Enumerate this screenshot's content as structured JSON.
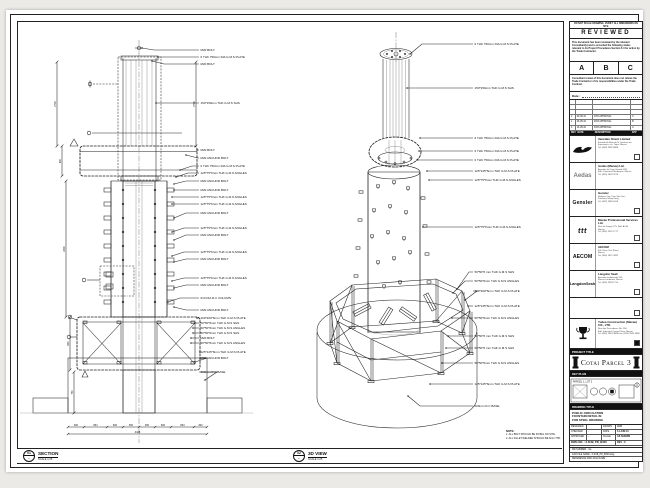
{
  "sheet_note": "DO NOT SCALE DRAWING. VERIFY ALL DIMENSIONS ON SITE.",
  "review": {
    "title": "REVIEWED",
    "para1": "This document has been reviewed by the relevant Consultant(s) and is accorded the following status relevant to its Project Procedures Section 5.4 for action by the Trade Contractor.",
    "statuses": [
      "A",
      "B",
      "C"
    ],
    "para2": "Consultant review of this document does not relieve the Trade Contractor of its responsibilities under the Trade Contract.",
    "date_label": "Date :"
  },
  "revisions": {
    "header": {
      "rev": "REV",
      "date": "DATE",
      "desc": "DESCRIPTION",
      "app": "APP"
    },
    "rows": [
      {
        "rev": "2",
        "date": "09-06-10",
        "desc": "FOR APPROVAL",
        "app": "C"
      },
      {
        "rev": "1",
        "date": "26-05-10",
        "desc": "FOR APPROVAL",
        "app": "B"
      },
      {
        "rev": "0",
        "date": "14-05-10",
        "desc": "FOR APPROVAL",
        "app": "A"
      }
    ]
  },
  "consultants": [
    {
      "name": "Venetian Orient Limited",
      "addr": "Estrada da Baía de N. Senhora da Esperança, s/n, Taipa, Macau\nTel: (853) 2882 8888"
    },
    {
      "name": "Aedas (Macau) Ltd.",
      "logo": "Aedas",
      "addr": "Avenida da Praia Grande 599,\nEdif. Comercial Rodrigues, Macau\nTel: (853) 2833 3278"
    },
    {
      "name": "Gensler",
      "logo": "Gensler",
      "addr": "Harbour City, Tsim Sha Tsui,\nKowloon, Hong Kong\nTel: (852) 2869 0418"
    },
    {
      "name": "Macau Professional Services Ltd.",
      "logo": "ttt",
      "addr": "Rua de Xangai 175, Edif. ACM,\nMacau\nTel: (853) 2870 1777"
    },
    {
      "name": "AECOM",
      "logo": "AECOM",
      "addr": "8/F China Civil Plaza,\nMacau\nTel: (853) 2872 3282"
    },
    {
      "name": "Langdon Seah",
      "logo": "LangdonSeah",
      "addr": "Avenida da Amizade 555,\nMacau Landmark, Macau\nTel: (853) 2833 1710"
    }
  ],
  "contractor": {
    "name": "Yudea Construction (Macau) CO., LTD.",
    "addr": "Rua dos Pescadores No. 166,\nEdif. Industrial Ocean Plaza, Macau\nTel: (853) 2843 3888  Fax: (853) 2843 3889"
  },
  "project": {
    "label": "PROJECT TITLE",
    "name": "Cotai Parcel 3"
  },
  "key_plan": {
    "label": "KEY PLAN",
    "tag": "PARCEL 1, LOT 2"
  },
  "drawing": {
    "label": "DRAWING TITLE",
    "title": "PUBLIC CIRCULATION\nFOUNTAIN DETAIL IN\nFOR STEEL DRAWING"
  },
  "fields": {
    "designed_label": "DESIGNED",
    "designed": "",
    "drawn_label": "DRAWN",
    "drawn": "LHO",
    "checked_label": "CHECKED",
    "checked": "-",
    "date_label": "DATE",
    "date": "14-JUN-10",
    "approved_label": "APPROVED",
    "approved": "-",
    "scale_label": "SCALE",
    "scale": "AS SHOWN",
    "dwg": "DWG NO. : 3-SUB_PD_B000",
    "rev": "REV : C"
  },
  "files": [
    "MD NUMBER : n/a",
    "CAD FILE NAME : 3-SUB_PD_B000.dwg",
    "REFERENCE DWG FILE NAME :"
  ],
  "views": {
    "section": {
      "num": "01",
      "ref": "-",
      "title": "SECTION",
      "scale": "SCALE 1:25"
    },
    "iso": {
      "num": "02",
      "ref": "-",
      "title": "3D VIEW",
      "scale": "SCALE 1:25"
    }
  },
  "notes": {
    "title": "NOTE:",
    "items": [
      "1. ALL BOLT SHOULD BE FIXING ON SITE.",
      "2. ALL FILLET WELDED SHOULD BE 6mm THK."
    ]
  },
  "section_view": {
    "callouts": [
      {
        "t": "M20 BOLT",
        "y": 50,
        "tx": 142,
        "ty": 48
      },
      {
        "t": "6 THK 750mm DIA G.M.S PLATE",
        "y": 57,
        "tx": 158
      },
      {
        "t": "M20 BOLT",
        "y": 64,
        "tx": 152,
        "ty": 61
      },
      {
        "t": "150*150mm THK G.M.S SHS",
        "y": 103,
        "tx": 156
      },
      {
        "t": "M20 BOLT",
        "y": 150,
        "tx": 197
      },
      {
        "t": "M20 ANCHOR BOLT",
        "y": 158,
        "tx": 186,
        "ty": 155
      },
      {
        "t": "6 THK 750mm DIA G.M.S PLATE",
        "y": 166,
        "tx": 180,
        "ty": 170
      },
      {
        "t": "125*75*6mm THK G.M.S ANGLES",
        "y": 173,
        "tx": 176,
        "ty": 177
      },
      {
        "t": "M20 ANCHOR BOLT",
        "y": 181,
        "tx": 174,
        "ty": 184
      },
      {
        "t": "M20 ANCHOR BOLT",
        "y": 190,
        "tx": 174
      },
      {
        "t": "125*75*6mm THK G.M.S ANGLES",
        "y": 197,
        "tx": 172
      },
      {
        "t": "125*75*6mm THK G.M.S ANGLES",
        "y": 204,
        "tx": 172
      },
      {
        "t": "M20 ANCHOR BOLT",
        "y": 213,
        "tx": 174,
        "ty": 218
      },
      {
        "t": "125*75*6mm THK G.M.S ANGLES",
        "y": 228,
        "tx": 172,
        "ty": 232
      },
      {
        "t": "M20 ANCHOR BOLT",
        "y": 235,
        "tx": 174,
        "ty": 240
      },
      {
        "t": "125*75*6mm THK G.M.S ANGLES",
        "y": 252,
        "tx": 172,
        "ty": 256
      },
      {
        "t": "M20 ANCHOR BOLT",
        "y": 259,
        "tx": 174,
        "ty": 262
      },
      {
        "t": "125*75*6mm THK G.M.S ANGLES",
        "y": 278,
        "tx": 172,
        "ty": 281
      },
      {
        "t": "M20 ANCHOR BOLT",
        "y": 285,
        "tx": 174,
        "ty": 288
      },
      {
        "t": "610 DIA R.C COLUMN",
        "y": 298,
        "tx": 168,
        "ty": 302
      },
      {
        "t": "M20 ANCHOR BOLT",
        "y": 310,
        "tx": 174,
        "ty": 307
      },
      {
        "t": "400*200*6mm THK G.M.S PLATE",
        "y": 318,
        "tx": 197
      },
      {
        "t": "50*50*6mm THK G.M.S SHS",
        "y": 323,
        "tx": 195
      },
      {
        "t": "50*50*6mm THK G.M.S ANGLES",
        "y": 328,
        "tx": 193
      },
      {
        "t": "50*50*6mm THK G.M.S SHS",
        "y": 333,
        "tx": 193
      },
      {
        "t": "M20 BOLT",
        "y": 338,
        "tx": 191
      },
      {
        "t": "50*50*6mm THK G.M.S ANGLES",
        "y": 343,
        "tx": 191
      },
      {
        "t": "125*125*6mm THK G.M.S PLATE",
        "y": 352,
        "tx": 200
      },
      {
        "t": "M20 ANCHOR BOLT",
        "y": 358,
        "tx": 195,
        "ty": 362
      },
      {
        "t": "600mm R.C BASE",
        "y": 372,
        "tx": 205,
        "ty": 380
      }
    ],
    "dims_v": [
      {
        "t": "2700",
        "x": 57,
        "y1": 62,
        "y2": 146
      },
      {
        "t": "800",
        "x": 62,
        "y1": 146,
        "y2": 176
      },
      {
        "t": "2400",
        "x": 66,
        "y1": 181,
        "y2": 317
      },
      {
        "t": "800",
        "x": 70,
        "y1": 317,
        "y2": 370
      },
      {
        "t": "750",
        "x": 74,
        "y1": 372,
        "y2": 413
      },
      {
        "t": "2700",
        "x": 196,
        "y1": 62,
        "y2": 146
      }
    ],
    "dims_h": {
      "y": 427,
      "ticks": [
        68,
        84,
        107,
        123,
        139,
        155,
        171,
        194,
        207
      ],
      "labels": [
        "300",
        "864",
        "600",
        "450",
        "450",
        "600",
        "864",
        "300"
      ],
      "total": "4428"
    }
  },
  "iso_view": {
    "callouts": [
      {
        "t": "6 THK 750mm DIA G.M.S PLATE",
        "y": 44,
        "tx": 410,
        "ty": 54
      },
      {
        "t": "150*150mm THK G.M.S SHS",
        "y": 88,
        "tx": 407
      },
      {
        "t": "6 THK 750mm DIA G.M.S PLATE",
        "y": 138,
        "tx": 420
      },
      {
        "t": "6 THK 750mm DIA G.M.S PLATE",
        "y": 151,
        "tx": 419
      },
      {
        "t": "6 THK 750mm DIA G.M.S PLATE",
        "y": 160,
        "tx": 417
      },
      {
        "t": "125*125*6mm THK G.M.S PLATE",
        "y": 171,
        "tx": 427
      },
      {
        "t": "125*75*6mm THK G.M.S ANGLES",
        "y": 180,
        "tx": 429
      },
      {
        "t": "125*75*6mm THK G.M.S ANGLES",
        "y": 227,
        "tx": 423
      },
      {
        "t": "50*50*6 mm THK G.M.S SHS",
        "y": 272,
        "tx": 457,
        "ty": 289
      },
      {
        "t": "50*50*6mm THK G.M.S ANGLES",
        "y": 281,
        "tx": 453,
        "ty": 293
      },
      {
        "t": "400*200*6mm THK G.M.S PLATE",
        "y": 291,
        "tx": 465,
        "ty": 300
      },
      {
        "t": "125*125*6mm THK G.M.S PLATE",
        "y": 306,
        "tx": 468
      },
      {
        "t": "50*50*6mm THK G.M.S ANGLES",
        "y": 318,
        "tx": 452
      },
      {
        "t": "50*50*6 mm THK G.M.S SHS",
        "y": 336,
        "tx": 448
      },
      {
        "t": "50*50*6 mm THK G.M.S SHS",
        "y": 348,
        "tx": 446
      },
      {
        "t": "50*50*6mm THK G.M.S ANGLES",
        "y": 363,
        "tx": 442
      },
      {
        "t": "125*125*6mm THK G.M.S PLATE",
        "y": 384,
        "tx": 430
      },
      {
        "t": "600mm R.C BASE",
        "y": 406,
        "tx": 408,
        "ty": 396
      }
    ]
  }
}
